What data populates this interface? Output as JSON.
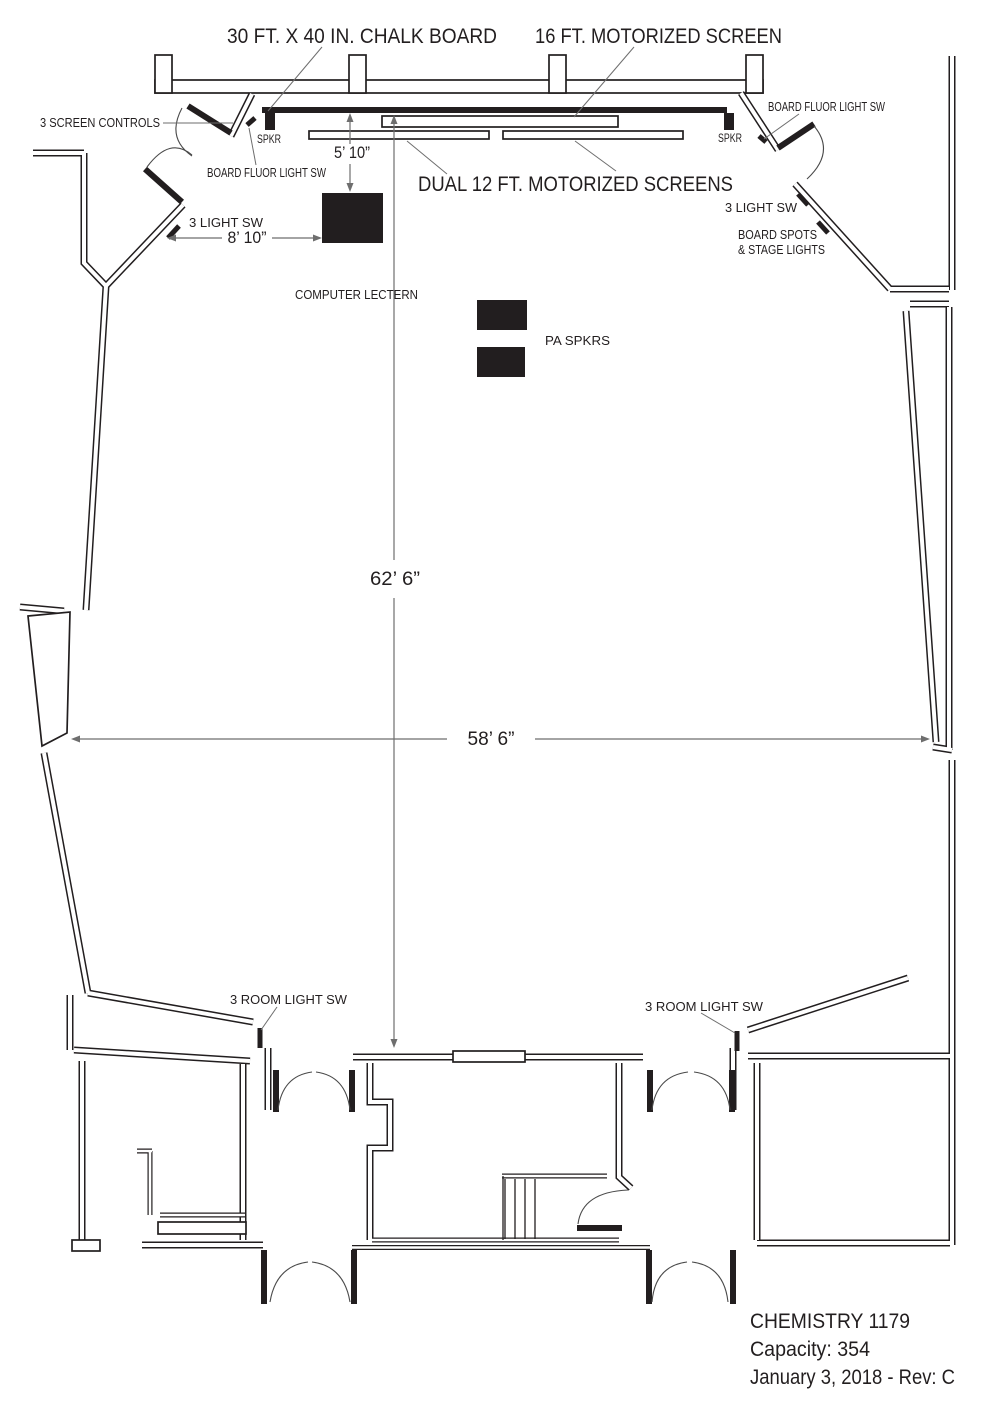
{
  "diagram": {
    "annotations": {
      "chalk_board": "30 FT. X 40 IN. CHALK BOARD",
      "motorized_screen_16ft": "16 FT. MOTORIZED SCREEN",
      "dual_screens": "DUAL 12 FT. MOTORIZED SCREENS",
      "screen_controls": "3 SCREEN CONTROLS",
      "spkr_left": "SPKR",
      "spkr_right": "SPKR",
      "board_fluor_light_sw_left": "BOARD FLUOR LIGHT SW",
      "board_fluor_light_sw_right": "BOARD FLUOR LIGHT SW",
      "light_sw_left": "3 LIGHT SW",
      "light_sw_right": "3 LIGHT SW",
      "board_spots_line1": "BOARD SPOTS",
      "board_spots_line2": "& STAGE LIGHTS",
      "computer_lectern": "COMPUTER LECTERN",
      "pa_spkrs": "PA SPKRS",
      "room_light_sw_left": "3 ROOM LIGHT SW",
      "room_light_sw_right": "3 ROOM LIGHT SW"
    },
    "dimensions": {
      "board_to_lectern": "5’ 10”",
      "wall_to_lectern": "8’ 10”",
      "room_depth": "62’ 6”",
      "room_width": "58’ 6”"
    },
    "title_block": {
      "room_name": "CHEMISTRY 1179",
      "capacity": "Capacity: 354",
      "date_revision": "January 3, 2018 - Rev: C"
    },
    "colors": {
      "ink": "#221e1f",
      "dimension_line": "#6e6e6e",
      "background": "#ffffff"
    }
  }
}
